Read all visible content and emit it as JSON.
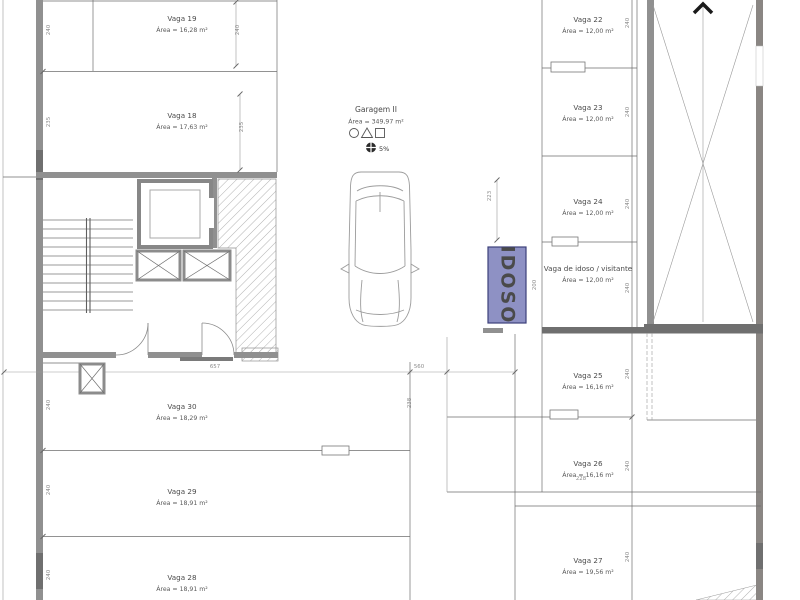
{
  "plan": {
    "garage": {
      "name": "Garagem II",
      "area": "Área = 349,97 m²",
      "slope": "5%"
    },
    "stalls": [
      {
        "name": "Vaga 19",
        "area": "Área = 16,28 m²"
      },
      {
        "name": "Vaga 18",
        "area": "Área = 17,63 m²"
      },
      {
        "name": "Vaga 22",
        "area": "Área = 12,00 m²"
      },
      {
        "name": "Vaga 23",
        "area": "Área = 12,00 m²"
      },
      {
        "name": "Vaga 24",
        "area": "Área = 12,00 m²"
      },
      {
        "name": "Vaga de idoso / visitante",
        "area": "Área = 12,00 m²"
      },
      {
        "name": "Vaga 25",
        "area": "Área = 16,16 m²"
      },
      {
        "name": "Vaga 26",
        "area": "Área = 16,16 m²"
      },
      {
        "name": "Vaga 27",
        "area": "Área = 19,56 m²"
      },
      {
        "name": "Vaga 30",
        "area": "Área = 18,29 m²"
      },
      {
        "name": "Vaga 29",
        "area": "Área = 18,91 m²"
      },
      {
        "name": "Vaga 28",
        "area": "Área = 18,91 m²"
      }
    ],
    "idoso_sign": {
      "label": "IDOSO",
      "fill": "#8e91c4",
      "text_color": "#2e3060"
    },
    "dims": {
      "w240": "240",
      "w235": "235",
      "w238": "238",
      "w223": "223",
      "w200": "200",
      "w657": "657",
      "w560": "560",
      "w228": "228"
    },
    "icons": {
      "ramp_arrow": "chevron-up",
      "garage_symbols": [
        "circle",
        "triangle",
        "square"
      ],
      "fan": "exhaust-fan"
    },
    "colors": {
      "line": "#6e6e6e",
      "wall": "#909090",
      "idoso_fill": "#8e91c4"
    }
  }
}
